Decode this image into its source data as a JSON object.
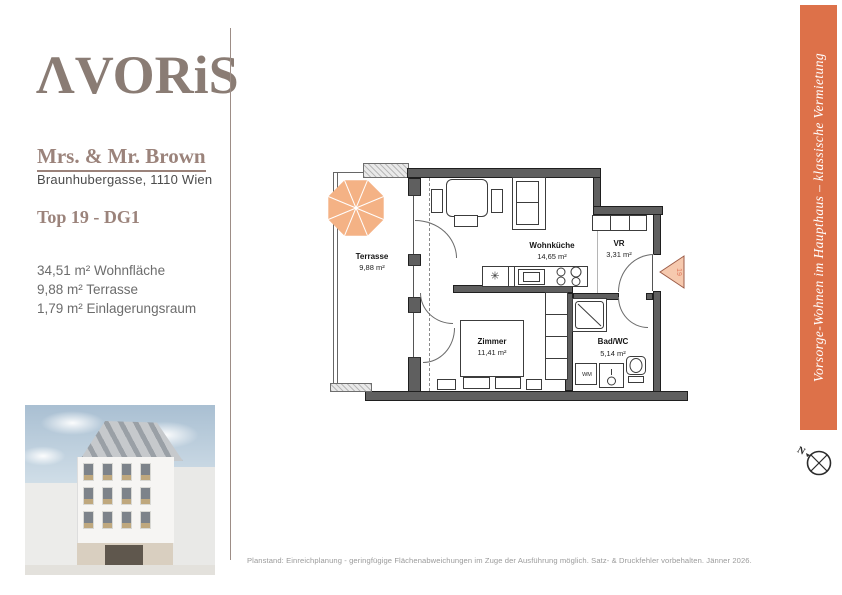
{
  "brand": {
    "logo_text": "ΛVORiS"
  },
  "client": {
    "name": "Mrs. & Mr. Brown",
    "address": "Braunhubergasse, 1110 Wien",
    "unit": "Top 19 - DG1"
  },
  "areas": {
    "line1": "34,51 m² Wohnfläche",
    "line2": "9,88 m² Terrasse",
    "line3": "1,79 m² Einlagerungsraum"
  },
  "floorplan": {
    "rooms": {
      "terrasse": {
        "name": "Terrasse",
        "area": "9,88 m²"
      },
      "wohnkueche": {
        "name": "Wohnküche",
        "area": "14,65 m²"
      },
      "vr": {
        "name": "VR",
        "area": "3,31 m²"
      },
      "zimmer": {
        "name": "Zimmer",
        "area": "11,41 m²"
      },
      "bad": {
        "name": "Bad/WC",
        "area": "5,14 m²"
      }
    },
    "labels": {
      "washing_machine": "WM",
      "unit_marker": "19",
      "compass_north": "N",
      "sink_symbol": "✳"
    }
  },
  "sidebar": {
    "text": "Vorsorge-Wohnen im Haupthaus – klassische Vermietung",
    "color": "#dd7149"
  },
  "footer": {
    "text": "Planstand: Einreichplanung - geringfügige Flächenabweichungen im Zuge der Ausführung möglich. Satz- & Druckfehler vorbehalten. Jänner 2026."
  },
  "colors": {
    "accent_orange": "#dd7149",
    "heading_mauve": "#9b837b",
    "logo_brown": "#8a7c74",
    "umbrella_orange": "#f4b285",
    "wall_gray": "#5f5f5f"
  }
}
